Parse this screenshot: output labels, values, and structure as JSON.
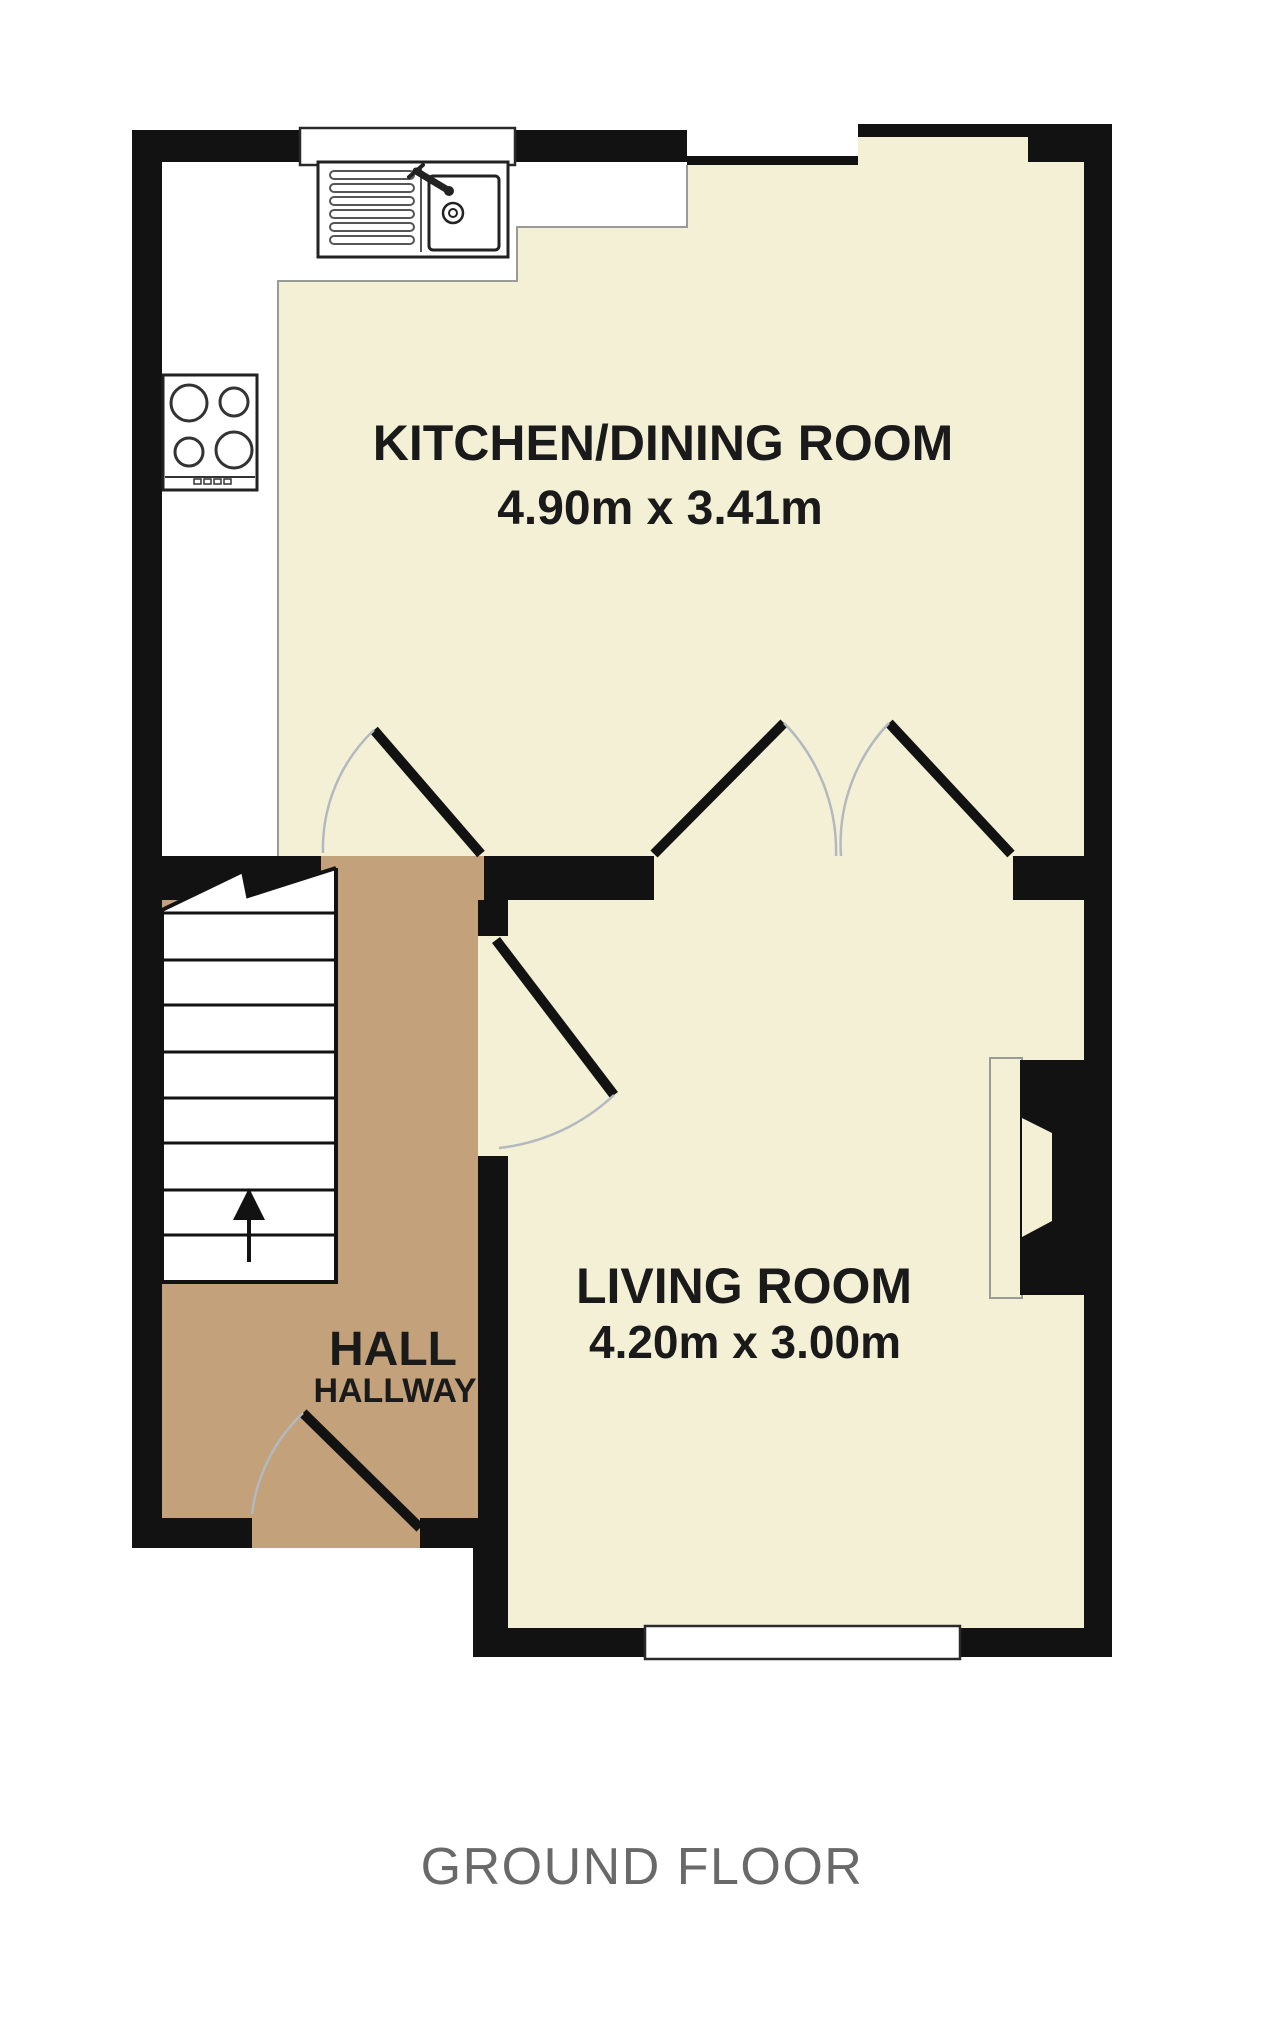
{
  "page": {
    "background": "#ffffff"
  },
  "colors": {
    "page-bg": "#ffffff",
    "room-fill": "#f4f0d6",
    "hall-fill": "#c2a17b",
    "wall": "#121212",
    "frame": "#2a2a2a",
    "arc": "#b3b9be",
    "counter-line": "#9a9a96",
    "fixture": "#222222",
    "label": "#1a1a1a",
    "caption": "#696969"
  },
  "rooms": {
    "kitchen": {
      "label": "KITCHEN/DINING ROOM",
      "dimensions": "4.90m x 3.41m"
    },
    "living": {
      "label": "LIVING ROOM",
      "dimensions": "4.20m x 3.00m"
    },
    "hall": {
      "label": "HALL",
      "sublabel": "HALLWAY"
    }
  },
  "caption": "GROUND FLOOR",
  "fixtures": {
    "sink": "kitchen-sink-icon",
    "hob": "hob-icon",
    "stairs": "staircase-icon",
    "stairs_direction": "up-arrow-icon",
    "fireplace": "fireplace-icon"
  }
}
